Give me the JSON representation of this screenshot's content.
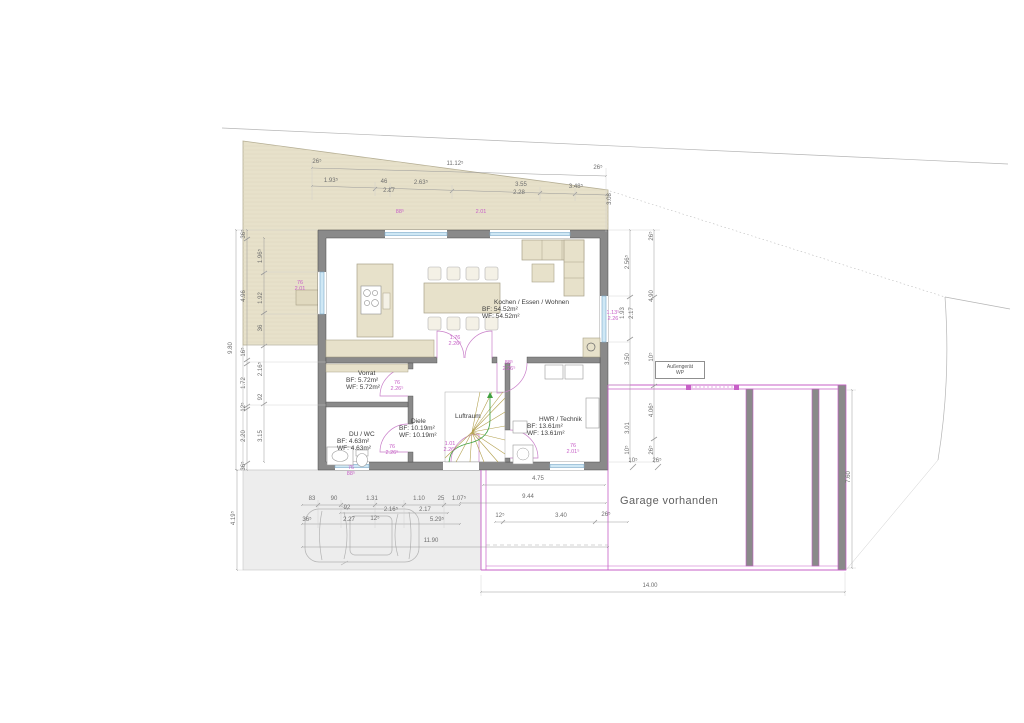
{
  "drawing": {
    "type": "floor-plan",
    "garage_note": "Garage vorhanden",
    "outdoor_unit": {
      "line1": "Außengerät",
      "line2": "WP"
    }
  },
  "colors": {
    "wall_gray": "#8a8a8a",
    "terrace_beige": "#e7e1ca",
    "window_blue": "#cfe8f5",
    "garage_pink": "#c75fc7",
    "stair_walkline_green": "#3fa03f",
    "driveway_gray": "#ededed",
    "dimension_gray": "#6e6e6e"
  },
  "rooms": [
    {
      "id": "living",
      "x": 482,
      "y": 299,
      "lines": [
        "Kochen / Essen / Wohnen",
        "BF:  54.52m²",
        "WF:  54.52m²"
      ]
    },
    {
      "id": "vorrat",
      "x": 346,
      "y": 370,
      "lines": [
        "Vorrat",
        "BF:  5.72m²",
        "WF:  5.72m²"
      ]
    },
    {
      "id": "du-wc",
      "x": 337,
      "y": 431,
      "lines": [
        "DU / WC",
        "BF:  4.63m²",
        "WF:  4.63m²"
      ]
    },
    {
      "id": "diele",
      "x": 399,
      "y": 418,
      "lines": [
        "Diele",
        "BF:  10.19m²",
        "WF:  10.19m²"
      ]
    },
    {
      "id": "hwr",
      "x": 527,
      "y": 416,
      "lines": [
        "HWR / Technik",
        "BF:  13.61m²",
        "WF:  13.61m²"
      ]
    },
    {
      "id": "luftraum",
      "x": 455,
      "y": 413,
      "lines": [
        "Luftraum"
      ]
    }
  ],
  "dimensions": [
    {
      "t": "26⁵",
      "x": 317,
      "y": 162
    },
    {
      "t": "11.12⁵",
      "x": 455,
      "y": 164
    },
    {
      "t": "26⁵",
      "x": 598,
      "y": 168
    },
    {
      "t": "1.93⁵",
      "x": 331,
      "y": 181
    },
    {
      "t": "46",
      "x": 384,
      "y": 182
    },
    {
      "t": "2.63⁵",
      "x": 421,
      "y": 183
    },
    {
      "t": "2.17",
      "x": 389,
      "y": 191
    },
    {
      "t": "3.55",
      "x": 521,
      "y": 185
    },
    {
      "t": "2.28",
      "x": 519,
      "y": 193
    },
    {
      "t": "3.48⁵",
      "x": 576,
      "y": 187
    },
    {
      "t": "3.08",
      "x": 610,
      "y": 199,
      "r": 1
    },
    {
      "t": "9.80",
      "x": 231,
      "y": 348,
      "r": 1
    },
    {
      "t": "36⁵",
      "x": 244,
      "y": 234,
      "r": 1
    },
    {
      "t": "4.96",
      "x": 244,
      "y": 296,
      "r": 1
    },
    {
      "t": "16⁵",
      "x": 244,
      "y": 352,
      "r": 1
    },
    {
      "t": "1.72",
      "x": 244,
      "y": 383,
      "r": 1
    },
    {
      "t": "12⁵",
      "x": 244,
      "y": 407,
      "r": 1
    },
    {
      "t": "2.20",
      "x": 244,
      "y": 436,
      "r": 1
    },
    {
      "t": "36⁵",
      "x": 244,
      "y": 466,
      "r": 1
    },
    {
      "t": "1.96⁵",
      "x": 261,
      "y": 256,
      "r": 1
    },
    {
      "t": "1.92",
      "x": 261,
      "y": 298,
      "r": 1
    },
    {
      "t": "36",
      "x": 261,
      "y": 328,
      "r": 1
    },
    {
      "t": "2.16⁵",
      "x": 261,
      "y": 369,
      "r": 1
    },
    {
      "t": "92",
      "x": 261,
      "y": 397,
      "r": 1
    },
    {
      "t": "3.15",
      "x": 261,
      "y": 436,
      "r": 1
    },
    {
      "t": "4.19⁵",
      "x": 234,
      "y": 518,
      "r": 1
    },
    {
      "t": "2.56⁵",
      "x": 628,
      "y": 262,
      "r": 1
    },
    {
      "t": "1.93",
      "x": 623,
      "y": 313,
      "r": 1
    },
    {
      "t": "2.17",
      "x": 632,
      "y": 313,
      "r": 1
    },
    {
      "t": "3.50",
      "x": 628,
      "y": 359,
      "r": 1
    },
    {
      "t": "3.01",
      "x": 628,
      "y": 428,
      "r": 1
    },
    {
      "t": "10⁵",
      "x": 628,
      "y": 450,
      "r": 1
    },
    {
      "t": "26⁵",
      "x": 652,
      "y": 236,
      "r": 1
    },
    {
      "t": "4.90",
      "x": 652,
      "y": 296,
      "r": 1
    },
    {
      "t": "10⁵",
      "x": 652,
      "y": 357,
      "r": 1
    },
    {
      "t": "4.06⁵",
      "x": 652,
      "y": 410,
      "r": 1
    },
    {
      "t": "26⁵",
      "x": 652,
      "y": 450,
      "r": 1
    },
    {
      "t": "7.60",
      "x": 849,
      "y": 477,
      "r": 1
    },
    {
      "t": "10⁵",
      "x": 633,
      "y": 461
    },
    {
      "t": "26⁵",
      "x": 657,
      "y": 461
    },
    {
      "t": "4.75",
      "x": 538,
      "y": 479
    },
    {
      "t": "9.44",
      "x": 528,
      "y": 497
    },
    {
      "t": "12⁵",
      "x": 500,
      "y": 516
    },
    {
      "t": "3.40",
      "x": 561,
      "y": 516
    },
    {
      "t": "26⁵",
      "x": 606,
      "y": 515
    },
    {
      "t": "14.00",
      "x": 650,
      "y": 586
    },
    {
      "t": "83",
      "x": 312,
      "y": 499
    },
    {
      "t": "90",
      "x": 334,
      "y": 499
    },
    {
      "t": "1.31",
      "x": 372,
      "y": 499
    },
    {
      "t": "1.10",
      "x": 419,
      "y": 499
    },
    {
      "t": "25",
      "x": 441,
      "y": 499
    },
    {
      "t": "1.07⁵",
      "x": 459,
      "y": 499
    },
    {
      "t": "92",
      "x": 347,
      "y": 508
    },
    {
      "t": "2.16⁵",
      "x": 391,
      "y": 510
    },
    {
      "t": "2.17",
      "x": 425,
      "y": 510
    },
    {
      "t": "36⁵",
      "x": 307,
      "y": 520
    },
    {
      "t": "2.27",
      "x": 349,
      "y": 520
    },
    {
      "t": "12⁵",
      "x": 375,
      "y": 519
    },
    {
      "t": "5.29⁵",
      "x": 437,
      "y": 520
    },
    {
      "t": "11.90",
      "x": 431,
      "y": 541
    }
  ],
  "opening_labels": [
    {
      "x": 400,
      "y": 212,
      "lines": [
        "88⁵"
      ]
    },
    {
      "x": 481,
      "y": 212,
      "lines": [
        "2.01"
      ]
    },
    {
      "x": 300,
      "y": 286,
      "lines": [
        "76",
        "2.01"
      ]
    },
    {
      "x": 613,
      "y": 316,
      "lines": [
        "1.13⁵",
        "2.26"
      ]
    },
    {
      "x": 455,
      "y": 341,
      "lines": [
        "1.76",
        "2.26⁵"
      ]
    },
    {
      "x": 509,
      "y": 366,
      "lines": [
        "88⁵",
        "2.26⁵"
      ]
    },
    {
      "x": 397,
      "y": 386,
      "lines": [
        "76",
        "2.26⁵"
      ]
    },
    {
      "x": 392,
      "y": 450,
      "lines": [
        "76",
        "2.26⁵"
      ]
    },
    {
      "x": 351,
      "y": 471,
      "lines": [
        "76",
        "88⁵"
      ]
    },
    {
      "x": 450,
      "y": 447,
      "lines": [
        "1.01",
        "2.26⁵"
      ]
    },
    {
      "x": 573,
      "y": 449,
      "lines": [
        "76",
        "2.01⁵"
      ]
    }
  ]
}
